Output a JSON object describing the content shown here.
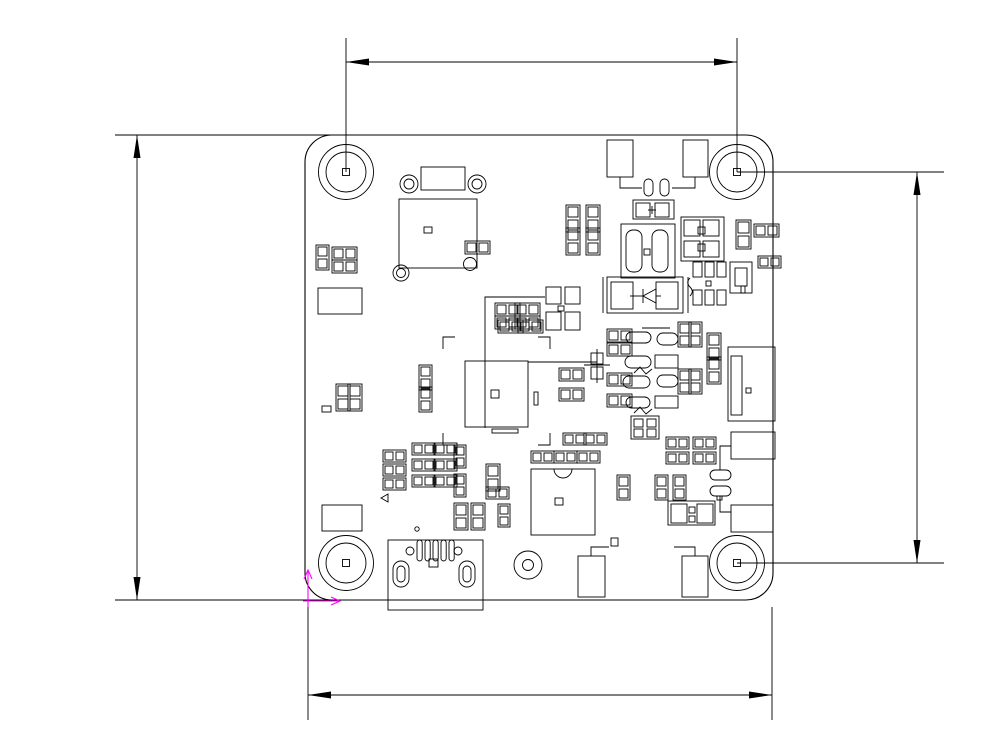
{
  "drawing": {
    "background": "#ffffff",
    "line_color": "#000000",
    "origin_marker_color": "#ff00ff",
    "dimensions": {
      "top": "33.5±0.1",
      "bottom": "40±0.1",
      "left": "40±0.1",
      "right": "33.5±0.1"
    },
    "board": {
      "silkscreen_title": "HB518EV30_MB_V01_RB",
      "silkscreen_subtitle": "15218EV3MB01",
      "labels": {
        "usb_pin1": "1",
        "usb_pin5": "5",
        "soic_pin1": "1",
        "soic_pin4": "4",
        "soic_pin5": "5",
        "conn_pin1": "1",
        "osc_mark_a": "1",
        "osc_mark_b": "1",
        "plus_top_right": "+",
        "plus_mid": "+",
        "minus_mid": "-",
        "plus_cap_left": "+",
        "plus_cap_right": "+",
        "plus_cap_c": "+",
        "plus_cap_d": "+"
      }
    }
  }
}
